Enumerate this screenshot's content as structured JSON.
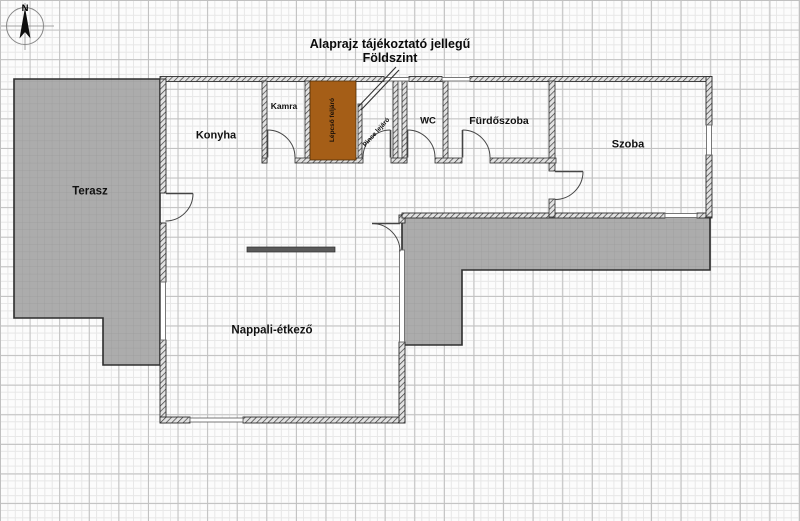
{
  "title": {
    "line1": "Alaprajz tájékoztató jellegű",
    "line2": "Földszint"
  },
  "compass": {
    "north_label": "N"
  },
  "rooms": {
    "terasz": {
      "label": "Terasz"
    },
    "konyha": {
      "label": "Konyha"
    },
    "kamra": {
      "label": "Kamra"
    },
    "lepcso": {
      "label": "Lépcső feljáró"
    },
    "pince": {
      "label": "Pince lejáró"
    },
    "wc": {
      "label": "WC"
    },
    "furdoszoba": {
      "label": "Fürdőszoba"
    },
    "szoba": {
      "label": "Szoba"
    },
    "nappali": {
      "label": "Nappali-étkező"
    }
  },
  "colors": {
    "stairs_fill": "#a55e17",
    "outdoor_fill": "#acacac",
    "outdoor_grid": "#9b9b9b",
    "wall_line": "#2e2e2e"
  }
}
